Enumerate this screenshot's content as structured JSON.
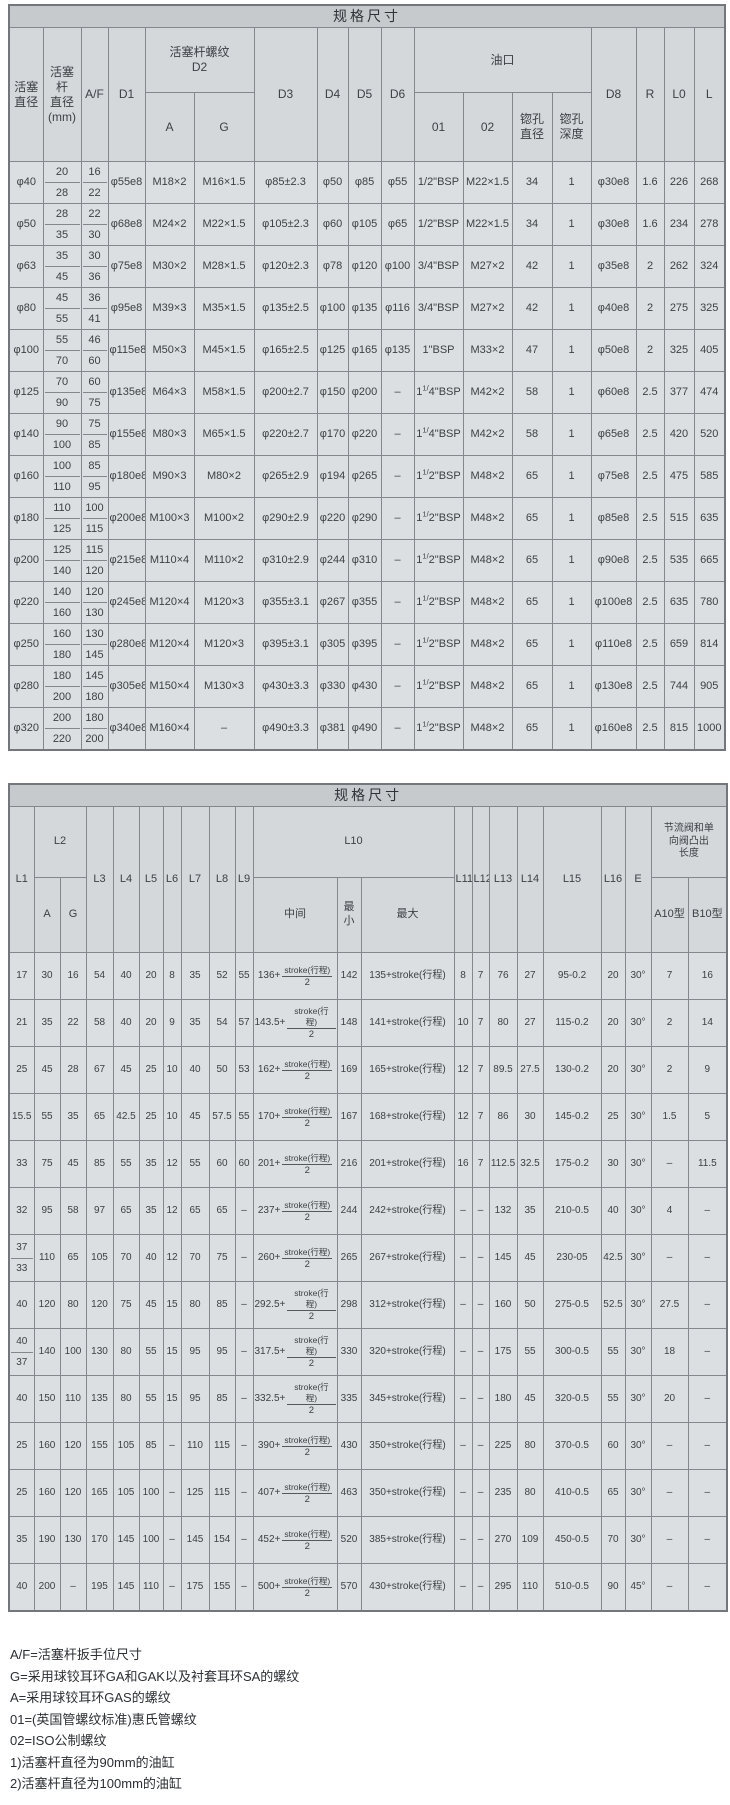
{
  "table1": {
    "title": "规格尺寸",
    "header": {
      "piston_dia": "活塞\n直径",
      "rod_dia": "活塞杆\n直径\n(mm)",
      "af": "A/F",
      "d1": "D1",
      "d2_group": "活塞杆螺纹\nD2",
      "d2_a": "A",
      "d2_g": "G",
      "d3": "D3",
      "d4": "D4",
      "d5": "D5",
      "d6": "D6",
      "port_group": "油口",
      "p01": "01",
      "p02": "02",
      "cb_dia": "锪孔\n直径",
      "cb_depth": "锪孔\n深度",
      "d8": "D8",
      "r": "R",
      "l0": "L0",
      "l": "L"
    },
    "rows": [
      [
        "φ40",
        [
          "20",
          "28"
        ],
        [
          "16",
          "22"
        ],
        "φ55e8",
        "M18×2",
        "M16×1.5",
        "φ85±2.3",
        "φ50",
        "φ85",
        "φ55",
        "1/2\"BSP",
        "M22×1.5",
        "34",
        "1",
        "φ30e8",
        "1.6",
        "226",
        "268"
      ],
      [
        "φ50",
        [
          "28",
          "35"
        ],
        [
          "22",
          "30"
        ],
        "φ68e8",
        "M24×2",
        "M22×1.5",
        "φ105±2.3",
        "φ60",
        "φ105",
        "φ65",
        "1/2\"BSP",
        "M22×1.5",
        "34",
        "1",
        "φ30e8",
        "1.6",
        "234",
        "278"
      ],
      [
        "φ63",
        [
          "35",
          "45"
        ],
        [
          "30",
          "36"
        ],
        "φ75e8",
        "M30×2",
        "M28×1.5",
        "φ120±2.3",
        "φ78",
        "φ120",
        "φ100",
        "3/4\"BSP",
        "M27×2",
        "42",
        "1",
        "φ35e8",
        "2",
        "262",
        "324"
      ],
      [
        "φ80",
        [
          "45",
          "55"
        ],
        [
          "36",
          "41"
        ],
        "φ95e8",
        "M39×3",
        "M35×1.5",
        "φ135±2.5",
        "φ100",
        "φ135",
        "φ116",
        "3/4\"BSP",
        "M27×2",
        "42",
        "1",
        "φ40e8",
        "2",
        "275",
        "325"
      ],
      [
        "φ100",
        [
          "55",
          "70"
        ],
        [
          "46",
          "60"
        ],
        "φ115e8",
        "M50×3",
        "M45×1.5",
        "φ165±2.5",
        "φ125",
        "φ165",
        "φ135",
        "1\"BSP",
        "M33×2",
        "47",
        "1",
        "φ50e8",
        "2",
        "325",
        "405"
      ],
      [
        "φ125",
        [
          "70",
          "90"
        ],
        [
          "60",
          "75"
        ],
        "φ135e8",
        "M64×3",
        "M58×1.5",
        "φ200±2.7",
        "φ150",
        "φ200",
        "–",
        {
          "b": [
            "1",
            "1/",
            "4\"BSP"
          ]
        },
        "M42×2",
        "58",
        "1",
        "φ60e8",
        "2.5",
        "377",
        "474"
      ],
      [
        "φ140",
        [
          "90",
          "100"
        ],
        [
          "75",
          "85"
        ],
        "φ155e8",
        "M80×3",
        "M65×1.5",
        "φ220±2.7",
        "φ170",
        "φ220",
        "–",
        {
          "b": [
            "1",
            "1/",
            "4\"BSP"
          ]
        },
        "M42×2",
        "58",
        "1",
        "φ65e8",
        "2.5",
        "420",
        "520"
      ],
      [
        "φ160",
        [
          "100",
          "110"
        ],
        [
          "85",
          "95"
        ],
        "φ180e8",
        "M90×3",
        "M80×2",
        "φ265±2.9",
        "φ194",
        "φ265",
        "–",
        {
          "b": [
            "1",
            "1/",
            "2\"BSP"
          ]
        },
        "M48×2",
        "65",
        "1",
        "φ75e8",
        "2.5",
        "475",
        "585"
      ],
      [
        "φ180",
        [
          "110",
          "125"
        ],
        [
          "100",
          "115"
        ],
        "φ200e8",
        "M100×3",
        "M100×2",
        "φ290±2.9",
        "φ220",
        "φ290",
        "–",
        {
          "b": [
            "1",
            "1/",
            "2\"BSP"
          ]
        },
        "M48×2",
        "65",
        "1",
        "φ85e8",
        "2.5",
        "515",
        "635"
      ],
      [
        "φ200",
        [
          "125",
          "140"
        ],
        [
          "115",
          "120"
        ],
        "φ215e8",
        "M110×4",
        "M110×2",
        "φ310±2.9",
        "φ244",
        "φ310",
        "–",
        {
          "b": [
            "1",
            "1/",
            "2\"BSP"
          ]
        },
        "M48×2",
        "65",
        "1",
        "φ90e8",
        "2.5",
        "535",
        "665"
      ],
      [
        "φ220",
        [
          "140",
          "160"
        ],
        [
          "120",
          "130"
        ],
        "φ245e8",
        "M120×4",
        "M120×3",
        "φ355±3.1",
        "φ267",
        "φ355",
        "–",
        {
          "b": [
            "1",
            "1/",
            "2\"BSP"
          ]
        },
        "M48×2",
        "65",
        "1",
        "φ100e8",
        "2.5",
        "635",
        "780"
      ],
      [
        "φ250",
        [
          "160",
          "180"
        ],
        [
          "130",
          "145"
        ],
        "φ280e8",
        "M120×4",
        "M120×3",
        "φ395±3.1",
        "φ305",
        "φ395",
        "–",
        {
          "b": [
            "1",
            "1/",
            "2\"BSP"
          ]
        },
        "M48×2",
        "65",
        "1",
        "φ110e8",
        "2.5",
        "659",
        "814"
      ],
      [
        "φ280",
        [
          "180",
          "200"
        ],
        [
          "145",
          "180"
        ],
        "φ305e8",
        "M150×4",
        "M130×3",
        "φ430±3.3",
        "φ330",
        "φ430",
        "–",
        {
          "b": [
            "1",
            "1/",
            "2\"BSP"
          ]
        },
        "M48×2",
        "65",
        "1",
        "φ130e8",
        "2.5",
        "744",
        "905"
      ],
      [
        "φ320",
        [
          "200",
          "220"
        ],
        [
          "180",
          "200"
        ],
        "φ340e8",
        "M160×4",
        "–",
        "φ490±3.3",
        "φ381",
        "φ490",
        "–",
        {
          "b": [
            "1",
            "1/",
            "2\"BSP"
          ]
        },
        "M48×2",
        "65",
        "1",
        "φ160e8",
        "2.5",
        "815",
        "1000"
      ]
    ]
  },
  "table2": {
    "title": "规格尺寸",
    "header": {
      "l1": "L1",
      "l2_group": "L2",
      "l2_a": "A",
      "l2_g": "G",
      "l3": "L3",
      "l4": "L4",
      "l5": "L5",
      "l6": "L6",
      "l7": "L7",
      "l8": "L8",
      "l9": "L9",
      "l10_group": "L10",
      "l10_mid": "中间",
      "l10_min": "最小",
      "l10_max": "最大",
      "l11": "L11",
      "l12": "L12",
      "l13": "L13",
      "l14": "L14",
      "l15": "L15",
      "l16": "L16",
      "e": "E",
      "valve_group": "节流阀和单\n向阀凸出\n长度",
      "a10": "A10型",
      "b10": "B10型"
    },
    "rows": [
      [
        "17",
        "30",
        "16",
        "54",
        "40",
        "20",
        "8",
        "35",
        "52",
        "55",
        {
          "f": [
            "136+",
            "stroke(行程)",
            "2"
          ]
        },
        "142",
        "135+stroke(行程)",
        "8",
        "7",
        "76",
        "27",
        "95-0.2",
        "20",
        "30°",
        "7",
        "16"
      ],
      [
        "21",
        "35",
        "22",
        "58",
        "40",
        "20",
        "9",
        "35",
        "54",
        "57",
        {
          "f": [
            "143.5+",
            "stroke(行程)",
            "2"
          ]
        },
        "148",
        "141+stroke(行程)",
        "10",
        "7",
        "80",
        "27",
        "115-0.2",
        "20",
        "30°",
        "2",
        "14"
      ],
      [
        "25",
        "45",
        "28",
        "67",
        "45",
        "25",
        "10",
        "40",
        "50",
        "53",
        {
          "f": [
            "162+",
            "stroke(行程)",
            "2"
          ]
        },
        "169",
        "165+stroke(行程)",
        "12",
        "7",
        "89.5",
        "27.5",
        "130-0.2",
        "20",
        "30°",
        "2",
        "9"
      ],
      [
        "15.5",
        "55",
        "35",
        "65",
        "42.5",
        "25",
        "10",
        "45",
        "57.5",
        "55",
        {
          "f": [
            "170+",
            "stroke(行程)",
            "2"
          ]
        },
        "167",
        "168+stroke(行程)",
        "12",
        "7",
        "86",
        "30",
        "145-0.2",
        "25",
        "30°",
        "1.5",
        "5"
      ],
      [
        "33",
        "75",
        "45",
        "85",
        "55",
        "35",
        "12",
        "55",
        "60",
        "60",
        {
          "f": [
            "201+",
            "stroke(行程)",
            "2"
          ]
        },
        "216",
        "201+stroke(行程)",
        "16",
        "7",
        "112.5",
        "32.5",
        "175-0.2",
        "30",
        "30°",
        "–",
        "11.5"
      ],
      [
        "32",
        "95",
        "58",
        "97",
        "65",
        "35",
        "12",
        "65",
        "65",
        "–",
        {
          "f": [
            "237+",
            "stroke(行程)",
            "2"
          ]
        },
        "244",
        "242+stroke(行程)",
        "–",
        "–",
        "132",
        "35",
        "210-0.5",
        "40",
        "30°",
        "4",
        "–"
      ],
      [
        [
          "37",
          "33"
        ],
        "110",
        "65",
        "105",
        "70",
        "40",
        "12",
        "70",
        "75",
        "–",
        {
          "f": [
            "260+",
            "stroke(行程)",
            "2"
          ]
        },
        "265",
        "267+stroke(行程)",
        "–",
        "–",
        "145",
        "45",
        "230-05",
        "42.5",
        "30°",
        "–",
        "–"
      ],
      [
        "40",
        "120",
        "80",
        "120",
        "75",
        "45",
        "15",
        "80",
        "85",
        "–",
        {
          "f": [
            "292.5+",
            "stroke(行程)",
            "2"
          ]
        },
        "298",
        "312+stroke(行程)",
        "–",
        "–",
        "160",
        "50",
        "275-0.5",
        "52.5",
        "30°",
        "27.5",
        "–"
      ],
      [
        [
          "40",
          "37"
        ],
        "140",
        "100",
        "130",
        "80",
        "55",
        "15",
        "95",
        "95",
        "–",
        {
          "f": [
            "317.5+",
            "stroke(行程)",
            "2"
          ]
        },
        "330",
        "320+stroke(行程)",
        "–",
        "–",
        "175",
        "55",
        "300-0.5",
        "55",
        "30°",
        "18",
        "–"
      ],
      [
        "40",
        "150",
        "110",
        "135",
        "80",
        "55",
        "15",
        "95",
        "85",
        "–",
        {
          "f": [
            "332.5+",
            "stroke(行程)",
            "2"
          ]
        },
        "335",
        "345+stroke(行程)",
        "–",
        "–",
        "180",
        "45",
        "320-0.5",
        "55",
        "30°",
        "20",
        "–"
      ],
      [
        "25",
        "160",
        "120",
        "155",
        "105",
        "85",
        "–",
        "110",
        "115",
        "–",
        {
          "f": [
            "390+",
            "stroke(行程)",
            "2"
          ]
        },
        "430",
        "350+stroke(行程)",
        "–",
        "–",
        "225",
        "80",
        "370-0.5",
        "60",
        "30°",
        "–",
        "–"
      ],
      [
        "25",
        "160",
        "120",
        "165",
        "105",
        "100",
        "–",
        "125",
        "115",
        "–",
        {
          "f": [
            "407+",
            "stroke(行程)",
            "2"
          ]
        },
        "463",
        "350+stroke(行程)",
        "–",
        "–",
        "235",
        "80",
        "410-0.5",
        "65",
        "30°",
        "–",
        "–"
      ],
      [
        "35",
        "190",
        "130",
        "170",
        "145",
        "100",
        "–",
        "145",
        "154",
        "–",
        {
          "f": [
            "452+",
            "stroke(行程)",
            "2"
          ]
        },
        "520",
        "385+stroke(行程)",
        "–",
        "–",
        "270",
        "109",
        "450-0.5",
        "70",
        "30°",
        "–",
        "–"
      ],
      [
        "40",
        "200",
        "–",
        "195",
        "145",
        "110",
        "–",
        "175",
        "155",
        "–",
        {
          "f": [
            "500+",
            "stroke(行程)",
            "2"
          ]
        },
        "570",
        "430+stroke(行程)",
        "–",
        "–",
        "295",
        "110",
        "510-0.5",
        "90",
        "45°",
        "–",
        "–"
      ]
    ]
  },
  "footnotes": [
    "A/F=活塞杆扳手位尺寸",
    "G=采用球铰耳环GA和GAK以及衬套耳环SA的螺纹",
    "A=采用球铰耳环GAS的螺纹",
    "01=(英国管螺纹标准)惠氏管螺纹",
    "02=ISO公制螺纹",
    "1)活塞杆直径为90mm的油缸",
    "2)活塞杆直径为100mm的油缸"
  ]
}
